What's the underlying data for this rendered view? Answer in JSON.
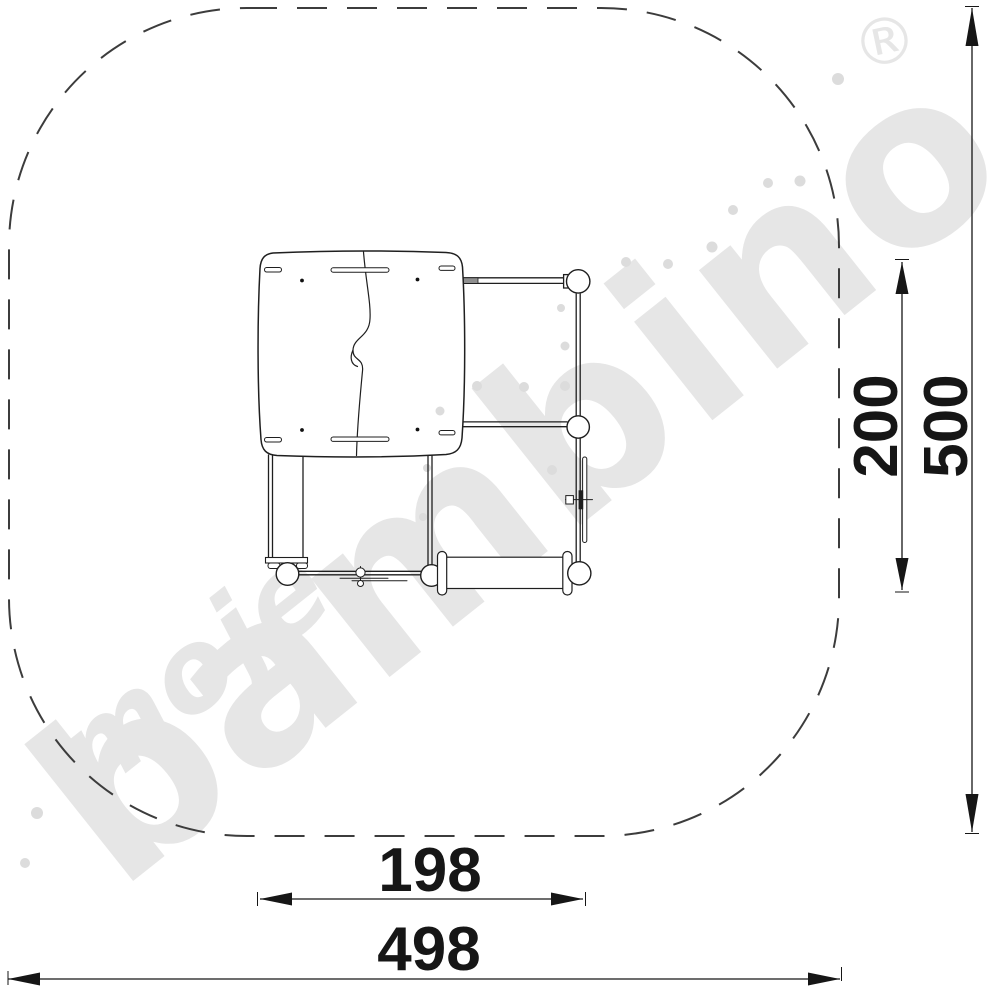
{
  "watermark": {
    "script_word": "moje",
    "brand_word": "bambino",
    "registered_mark": "®"
  },
  "dimensions": {
    "inner_width": {
      "value": "198"
    },
    "total_width": {
      "value": "498"
    },
    "inner_height": {
      "value": "200"
    },
    "total_height": {
      "value": "500"
    }
  },
  "colors": {
    "background": "#ffffff",
    "line": "#1f1f1f",
    "dimension": "#161616",
    "watermark": "#e6e6e6",
    "watermark_dots": "#dcdcdc"
  }
}
